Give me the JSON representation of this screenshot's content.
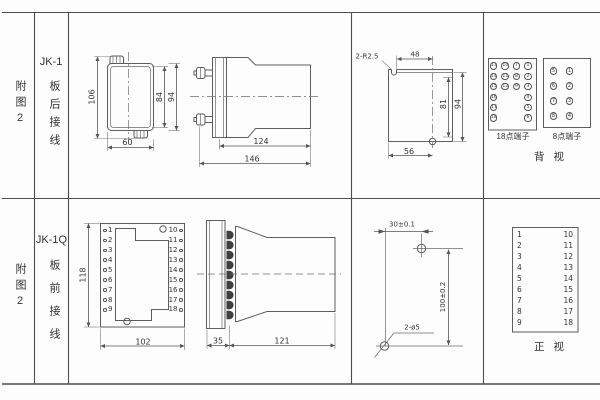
{
  "table": {
    "rows": [
      {
        "fig": "附图2",
        "model": "JK-1",
        "wiring": "板后接线"
      },
      {
        "fig": "附图2",
        "model": "JK-1Q",
        "wiring": "板前接线"
      }
    ]
  },
  "rear_view": {
    "dims": {
      "height_total": "106",
      "height_inner": "84",
      "height_outer": "94",
      "width": "60",
      "depth_body": "124",
      "depth_total": "146"
    },
    "cutout": {
      "slots": "2-R2.5",
      "top_width": "48",
      "height_inner": "81",
      "height_outer": "94",
      "bottom_width": "56"
    },
    "terminals18": {
      "label": "18点端子",
      "cells": [
        [
          13,
          10,
          7,
          1
        ],
        [
          14,
          11,
          8,
          2
        ],
        [
          15,
          12,
          9,
          3
        ],
        [
          16,
          null,
          null,
          4
        ],
        [
          17,
          null,
          null,
          5
        ],
        [
          18,
          null,
          null,
          6
        ]
      ]
    },
    "terminals8": {
      "label": "8点端子",
      "cells": [
        [
          5,
          1
        ],
        [
          6,
          2
        ],
        [
          7,
          3
        ],
        [
          8,
          4
        ]
      ]
    },
    "view_label": "背 视"
  },
  "front_view": {
    "dims": {
      "height": "118",
      "width": "102",
      "flange_depth": "35",
      "body_depth": "121"
    },
    "drill": {
      "h_dist": "30±0.1",
      "v_dist": "100±0.2",
      "holes": "2-ø5"
    },
    "panel": {
      "left": [
        1,
        2,
        3,
        4,
        5,
        6,
        7,
        8,
        9
      ],
      "right": [
        10,
        11,
        12,
        13,
        14,
        15,
        16,
        17,
        18
      ]
    },
    "table": {
      "left": [
        1,
        2,
        3,
        4,
        5,
        6,
        7,
        8,
        9
      ],
      "right": [
        10,
        11,
        12,
        13,
        14,
        15,
        16,
        17,
        18
      ]
    },
    "view_label": "正 视"
  }
}
